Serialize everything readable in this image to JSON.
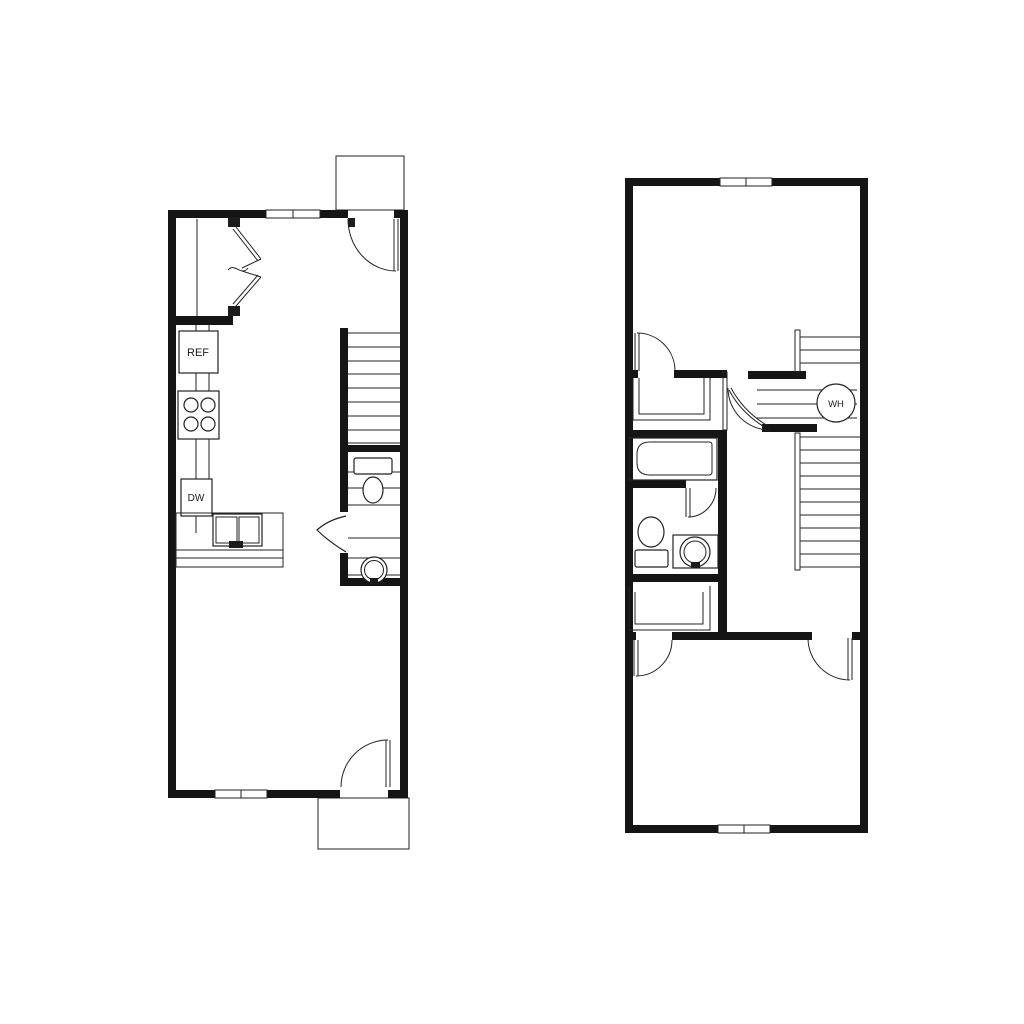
{
  "page": {
    "background_color": "#ffffff",
    "ink_color": "#151515",
    "description": "black-and-white architectural floor plan, two stacked unit levels side by side"
  },
  "floor1": {
    "name": "first-floor-plan",
    "labels": {
      "refrigerator": "REF",
      "dishwasher": "DW"
    },
    "fixtures": [
      "bifold-closet",
      "refrigerator",
      "range-4-burner",
      "dishwasher",
      "double-sink-counter",
      "staircase",
      "powder-room-toilet",
      "powder-room-sink",
      "entry-door",
      "rear-door",
      "entry-stoop",
      "rear-stoop",
      "window-top",
      "window-bottom"
    ]
  },
  "floor2": {
    "name": "second-floor-plan",
    "labels": {
      "water_heater": "WH"
    },
    "fixtures": [
      "bathtub",
      "toilet",
      "vanity-sink",
      "staircase",
      "water-heater-closet",
      "bedroom-closet-top",
      "bedroom-closet-bottom",
      "bedroom-door-top",
      "bathroom-door",
      "water-heater-door",
      "bedroom-door-left",
      "bedroom-door-right",
      "window-top",
      "window-bottom"
    ]
  }
}
